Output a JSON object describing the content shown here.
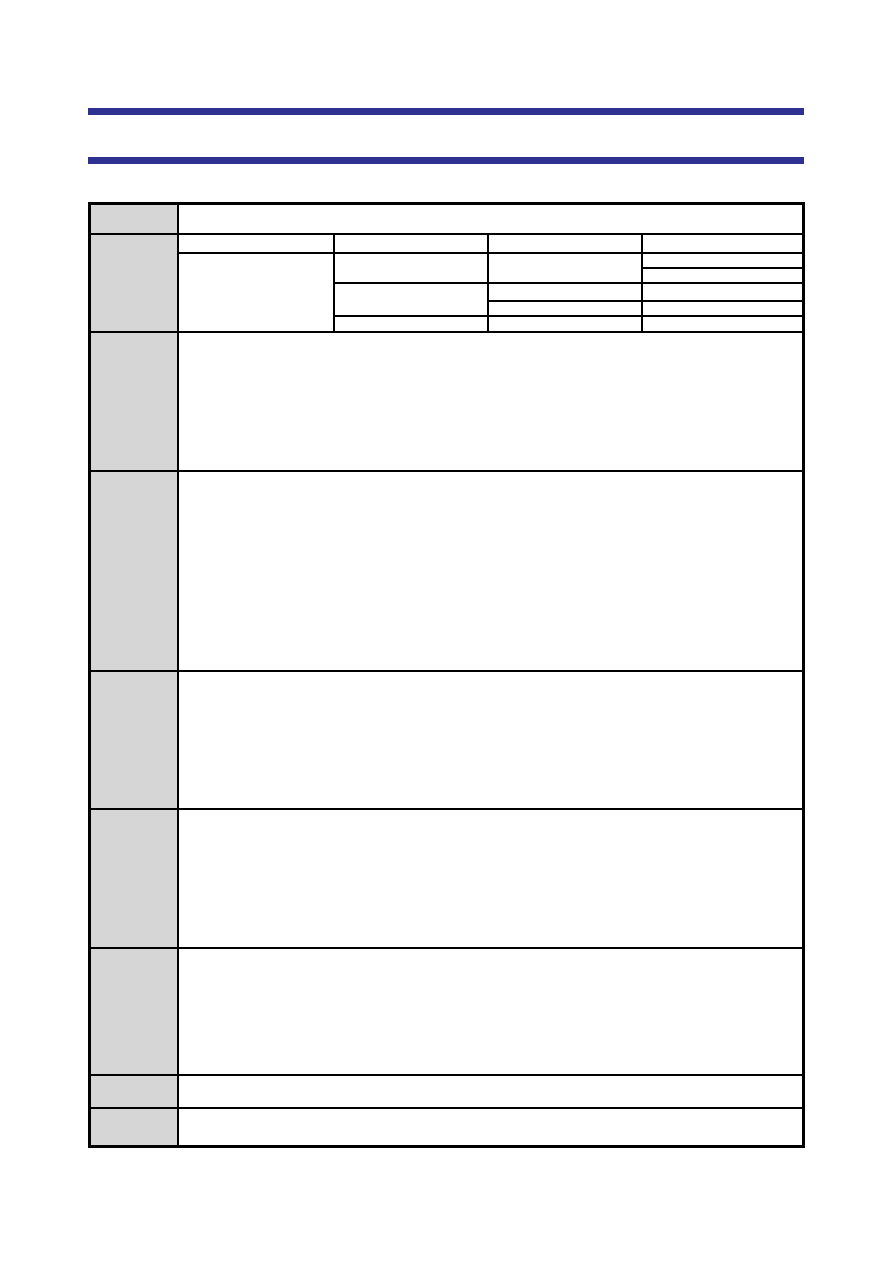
{
  "page": {
    "background_color": "#ffffff",
    "width_px": 893,
    "height_px": 1262,
    "visible_text": ""
  },
  "decor_bars": {
    "color": "#2e3192",
    "items": [
      {
        "name": "chapter-rule-primary",
        "text": ""
      },
      {
        "name": "chapter-rule-secondary",
        "text": ""
      }
    ]
  },
  "spec_table": {
    "outer_border_color": "#000000",
    "grid_line_color": "#000000",
    "label_column_background": "#d6d6d6",
    "row_count": 9,
    "rows": [
      {
        "label": "",
        "content": ""
      },
      {
        "label": "",
        "content": ""
      },
      {
        "label": "",
        "content": ""
      },
      {
        "label": "",
        "content": ""
      },
      {
        "label": "",
        "content": ""
      },
      {
        "label": "",
        "content": ""
      },
      {
        "label": "",
        "content": ""
      },
      {
        "label": "",
        "content": ""
      },
      {
        "label": "",
        "content": ""
      }
    ],
    "nested_grid": {
      "host_row_index": 1,
      "columns": 4,
      "sub_rows": 6,
      "header_row": {
        "cells": [
          "",
          "",
          "",
          ""
        ]
      },
      "body_cells": {
        "col_a_merged": "",
        "col_b_span_r2_r3": "",
        "col_b_span_r4_r5": "",
        "col_b_r6": "",
        "col_c_span_r2_r3": "",
        "col_c_r4": "",
        "col_c_r5": "",
        "col_c_r6": "",
        "col_d_r2": "",
        "col_d_r3": "",
        "col_d_r4": "",
        "col_d_r5": "",
        "col_d_r6": ""
      }
    }
  }
}
